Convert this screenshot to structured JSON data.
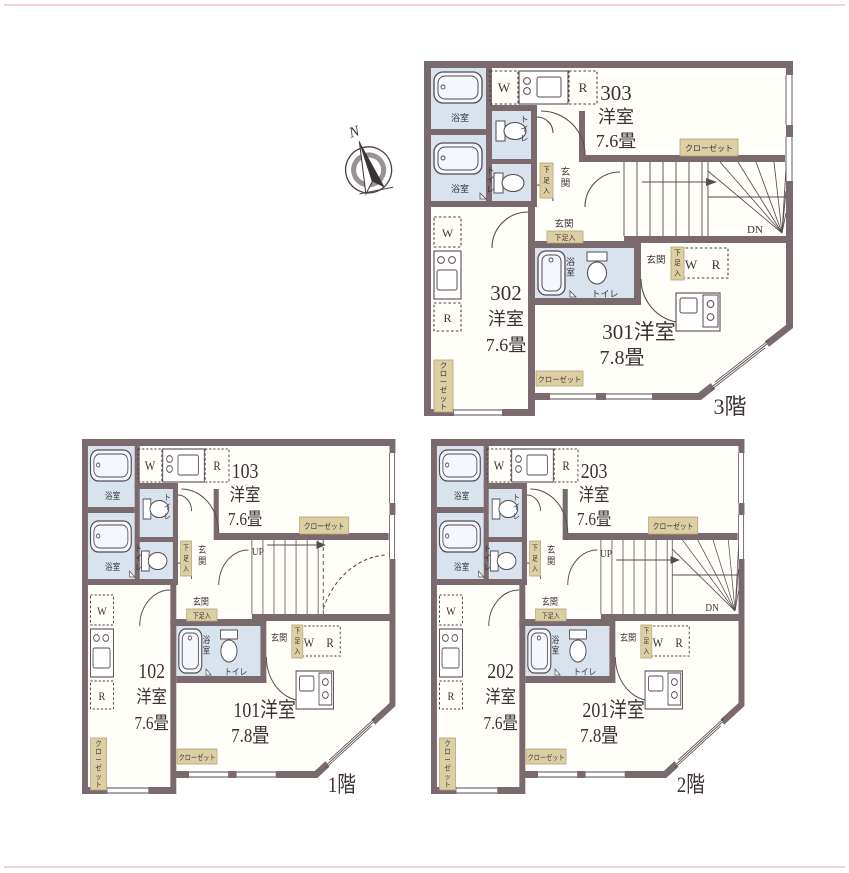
{
  "page": {
    "background": "#ffffff"
  },
  "compass": {
    "label": "N"
  },
  "colors": {
    "wall": "#7a696d",
    "wet": "#d8e3ee",
    "tan": "#ddcfa4",
    "tan_border": "#b3a273",
    "room": "#fffef8",
    "line": "#564b50",
    "dash": "#4a4145",
    "text": "#3a3236",
    "scan": "#f0c6cf"
  },
  "labels": {
    "bath": "浴室",
    "toilet": "トイレ",
    "entrance": "玄関",
    "shoe": "下足入",
    "closet": "クローゼット",
    "washer": "W",
    "fridge": "R",
    "up": "UP",
    "down": "DN"
  },
  "floors": [
    {
      "id": "3f",
      "label": "3階",
      "stairs": "dn",
      "units": [
        {
          "number": "303",
          "type": "洋室",
          "size": "7.6畳"
        },
        {
          "number": "302",
          "type": "洋室",
          "size": "7.6畳"
        },
        {
          "number": "301",
          "type": "洋室",
          "size": "7.8畳"
        }
      ]
    },
    {
      "id": "1f",
      "label": "1階",
      "stairs": "up",
      "units": [
        {
          "number": "103",
          "type": "洋室",
          "size": "7.6畳"
        },
        {
          "number": "102",
          "type": "洋室",
          "size": "7.6畳"
        },
        {
          "number": "101",
          "type": "洋室",
          "size": "7.8畳"
        }
      ]
    },
    {
      "id": "2f",
      "label": "2階",
      "stairs": "updn",
      "units": [
        {
          "number": "203",
          "type": "洋室",
          "size": "7.6畳"
        },
        {
          "number": "202",
          "type": "洋室",
          "size": "7.6畳"
        },
        {
          "number": "201",
          "type": "洋室",
          "size": "7.8畳"
        }
      ]
    }
  ]
}
